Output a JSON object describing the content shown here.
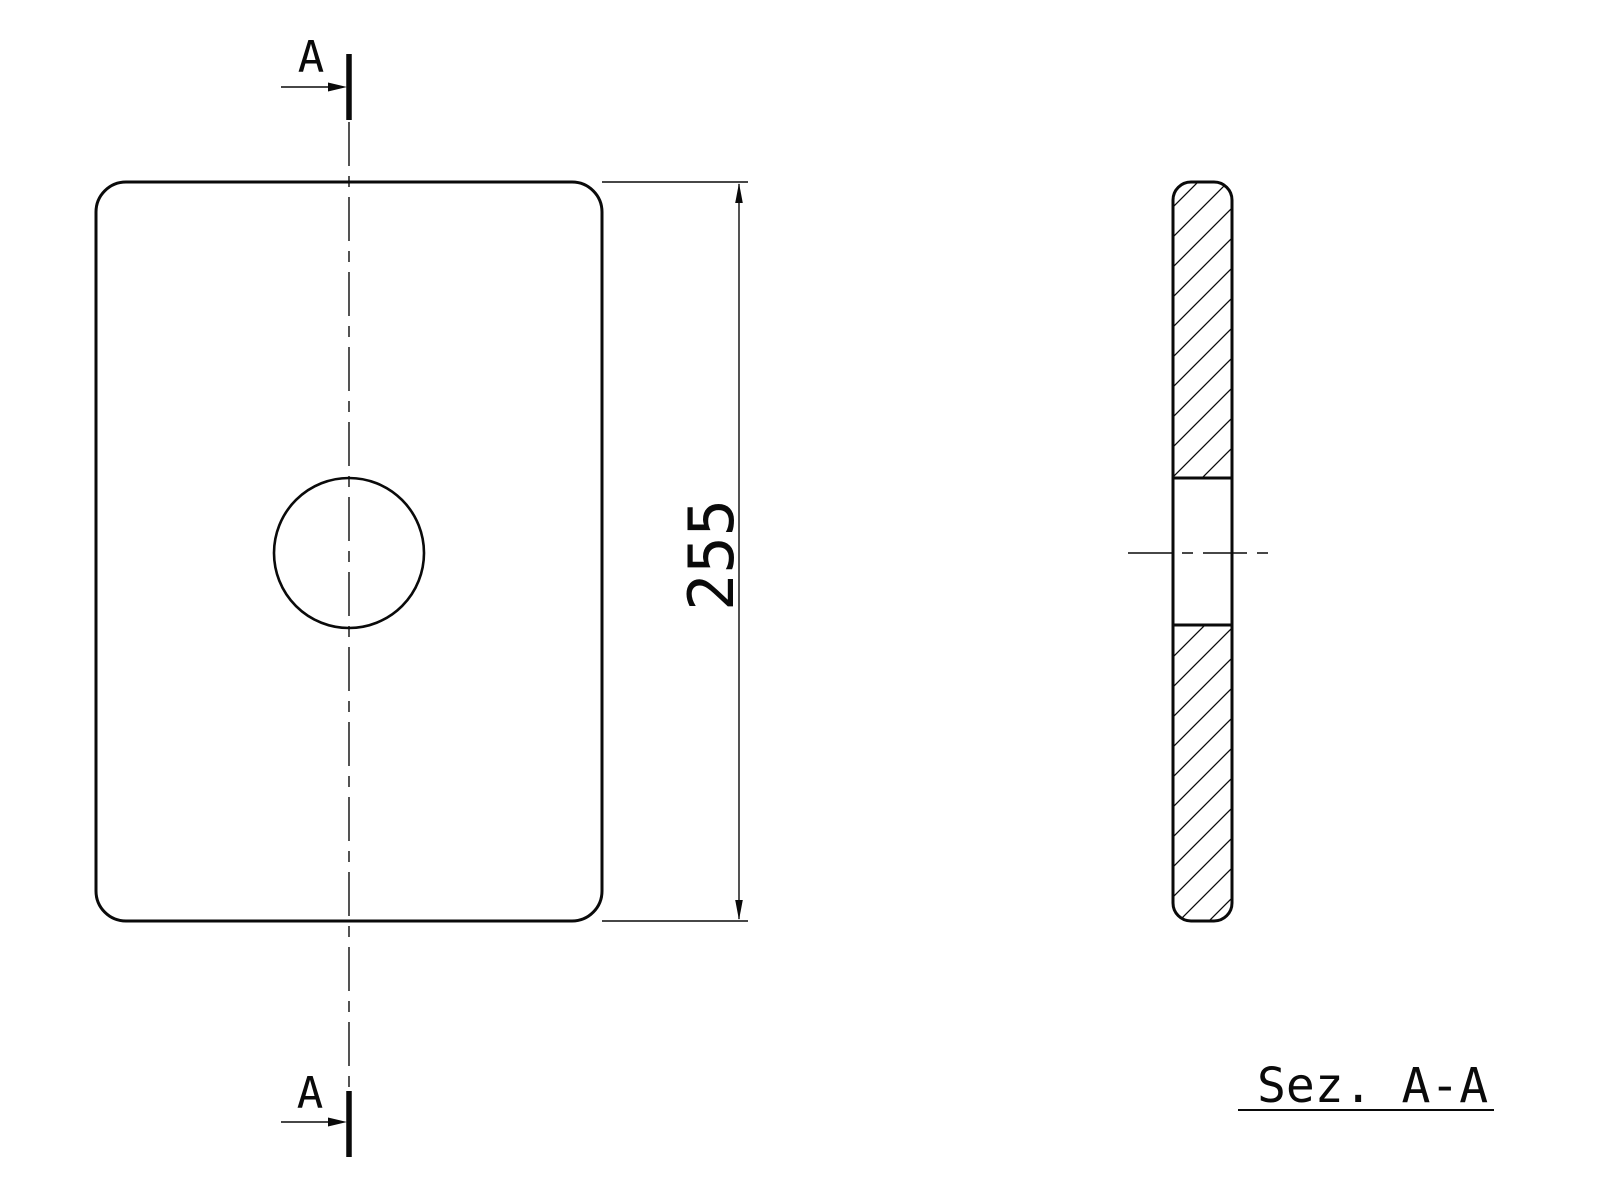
{
  "page": {
    "background": "#ffffff",
    "line_color": "#0a0a0a",
    "drawing_type": "technical-drawing"
  },
  "front_view": {
    "cut_label_top": "A",
    "cut_label_bottom": "A"
  },
  "dimension": {
    "height_value": "255"
  },
  "section_view": {
    "title": "Sez. A-A"
  }
}
